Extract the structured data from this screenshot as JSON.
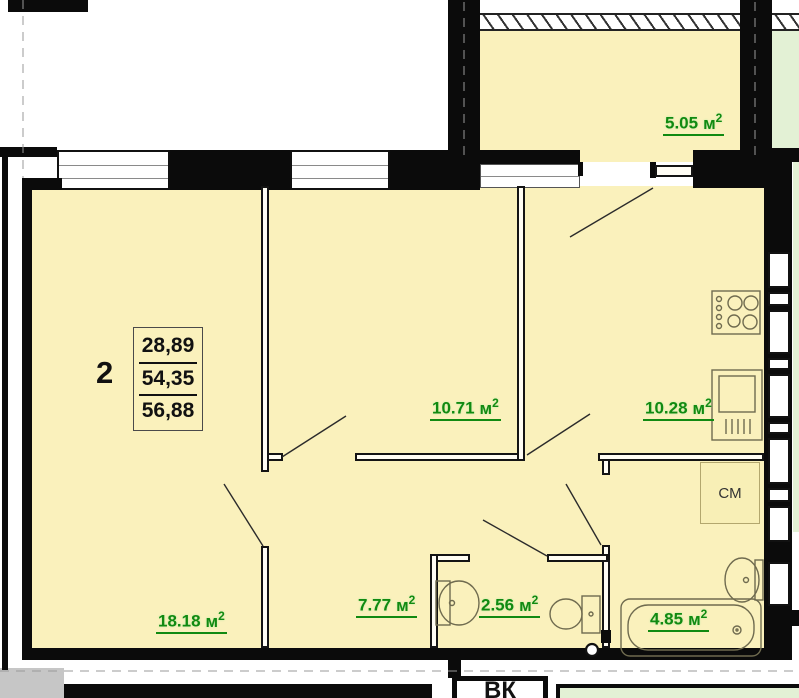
{
  "plan": {
    "apartment": {
      "number": "2",
      "area_living": "28,89",
      "area_usable": "54,35",
      "area_total": "56,88"
    },
    "unit": "м",
    "unit_sup": "2",
    "rooms": [
      {
        "id": "balcony",
        "area": "5.05"
      },
      {
        "id": "bedroom",
        "area": "10.71"
      },
      {
        "id": "kitchen",
        "area": "10.28"
      },
      {
        "id": "living-room",
        "area": "18.18"
      },
      {
        "id": "hall",
        "area": "7.77"
      },
      {
        "id": "wc",
        "area": "2.56"
      },
      {
        "id": "bathroom",
        "area": "4.85"
      }
    ],
    "annotations": {
      "washing_machine": "СМ",
      "vent_shaft": "ВК"
    },
    "colors": {
      "floor_fill": "#FAF1BC",
      "neighbor_balcony_fill": "#E3F1D5",
      "area_label_green": "#118A11",
      "wall_black": "#0B0B0B"
    }
  }
}
